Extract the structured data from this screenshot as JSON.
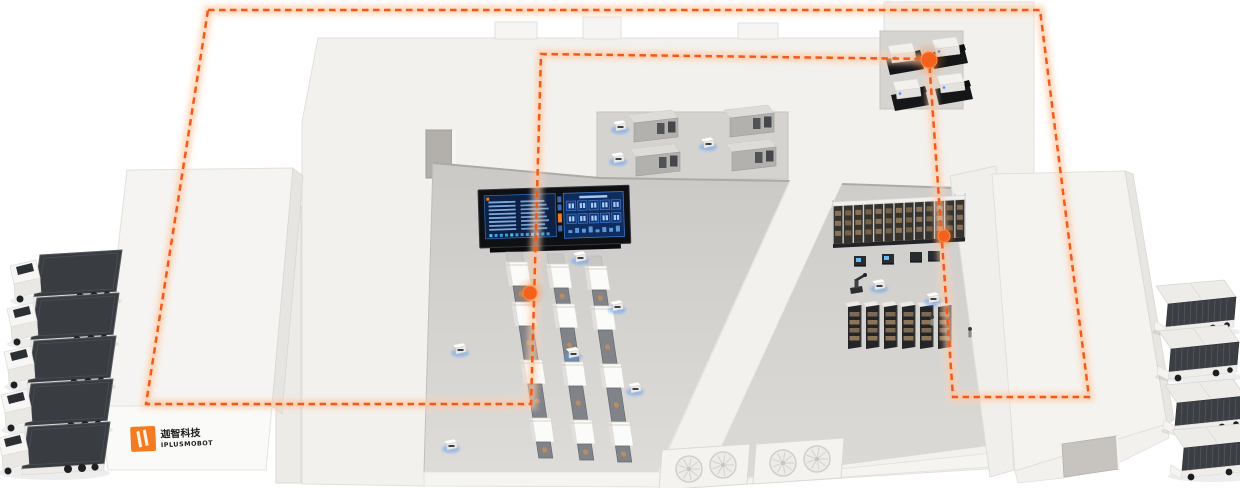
{
  "meta": {
    "description": "Isometric smart-factory / warehouse illustration with an orange dashed AMR route loop, glowing waypoints, docked trucks, production lines, storage racks and a control dashboard",
    "canvas": {
      "width": 1240,
      "height": 488
    }
  },
  "colors": {
    "accent_orange": "#f47b20",
    "route_orange": "#f4591a",
    "route_glow": "#ffbe92",
    "building_white": "#f2f1ee",
    "floor_gray": "#d6d4d1",
    "equipment_dark": "#2b2d31",
    "screen_navy": "#0c2145",
    "screen_blue": "#84b2e7",
    "screen_cyan": "#49c6e9",
    "glow_blue": "#5b9cf5",
    "truck_container_gray": "#393c41"
  },
  "logo": {
    "icon": "orange-gate-icon",
    "company_cn": "迦智科技",
    "company_en": "IPLUSMOBOT"
  },
  "route": {
    "style": "dashed",
    "closed": true,
    "points": [
      [
        208,
        10
      ],
      [
        1040,
        10
      ],
      [
        1089,
        397
      ],
      [
        953,
        397
      ],
      [
        929,
        59
      ],
      [
        541,
        54
      ],
      [
        531,
        404
      ],
      [
        146,
        404
      ]
    ],
    "waypoints": [
      {
        "x": 929,
        "y": 60,
        "r": 8
      },
      {
        "x": 944,
        "y": 236,
        "r": 6
      },
      {
        "x": 530,
        "y": 293,
        "r": 7
      }
    ]
  },
  "vehicles": {
    "trucks_left": {
      "count": 5,
      "positions": [
        [
          4,
          248
        ],
        [
          1,
          291
        ],
        [
          -2,
          334
        ],
        [
          -5,
          377
        ],
        [
          -8,
          420
        ]
      ]
    },
    "trucks_right": {
      "count": 4,
      "positions": [
        [
          1148,
          280
        ],
        [
          1151,
          325
        ],
        [
          1157,
          379
        ],
        [
          1164,
          424
        ]
      ]
    }
  },
  "robots": {
    "agvs_floor": [
      [
        453,
        343
      ],
      [
        573,
        251
      ],
      [
        610,
        300
      ],
      [
        566,
        347
      ],
      [
        628,
        382
      ],
      [
        444,
        439
      ],
      [
        872,
        279
      ],
      [
        926,
        292
      ]
    ],
    "agvs_mezzanine": [
      [
        613,
        120
      ],
      [
        611,
        152
      ],
      [
        701,
        137
      ]
    ],
    "charging_docks": [
      [
        854,
        256
      ],
      [
        882,
        254
      ],
      [
        910,
        252
      ],
      [
        928,
        251
      ]
    ],
    "robot_arm": [
      850,
      276
    ],
    "people": [
      [
        930,
        315
      ],
      [
        968,
        327
      ]
    ]
  },
  "equipment": {
    "production_lines": {
      "count": 3,
      "origins": [
        [
          504,
          252
        ],
        [
          545,
          254
        ],
        [
          583,
          256
        ]
      ],
      "lean_deg": 8.5,
      "segments": [
        [
          "cap",
          10
        ],
        [
          "machine",
          24
        ],
        [
          "conv",
          16
        ],
        [
          "machine",
          24
        ],
        [
          "conv",
          34
        ],
        [
          "machine",
          24
        ],
        [
          "conv",
          34
        ],
        [
          "machine",
          24
        ],
        [
          "conv",
          16
        ]
      ]
    },
    "cnc_machines": [
      [
        886,
        44
      ],
      [
        930,
        38
      ],
      [
        891,
        80
      ],
      [
        935,
        74
      ]
    ],
    "mezzanine_machines": [
      [
        628,
        110
      ],
      [
        724,
        105
      ],
      [
        630,
        144
      ],
      [
        726,
        139
      ]
    ],
    "asrs_rack": {
      "x": 833,
      "y": 206,
      "width": 132,
      "bays": 13,
      "slant": -0.05,
      "height": 38
    },
    "floor_racks": {
      "count": 6,
      "x": 845,
      "y": 303,
      "step": 18
    },
    "hvac_units": [
      {
        "x": 662,
        "y": 444,
        "fans": 2
      },
      {
        "x": 756,
        "y": 438,
        "fans": 2
      }
    ]
  },
  "dashboard": {
    "left_rows": 8,
    "left_minibars": 12,
    "kpi_rows": 2,
    "kpi_cols": 5,
    "right_bottom_bars": 8
  }
}
